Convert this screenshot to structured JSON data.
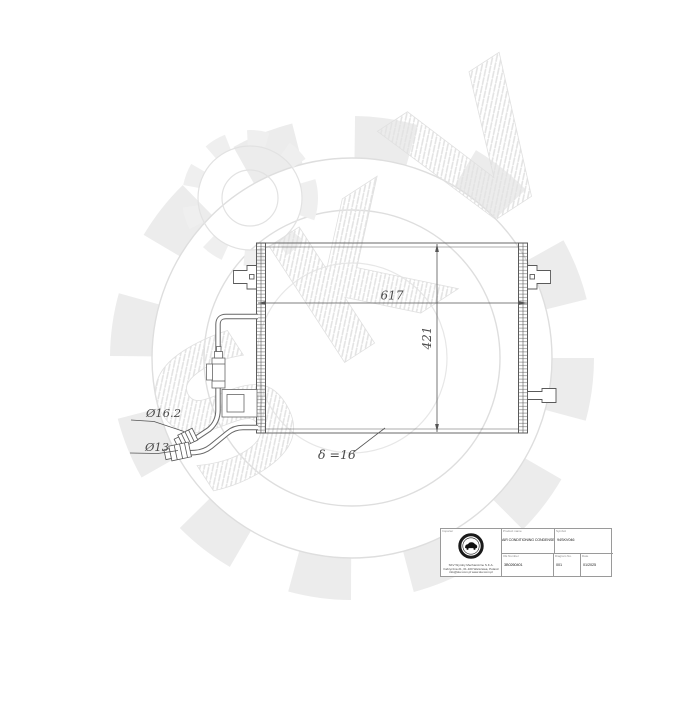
{
  "watermark": {
    "letters": [
      "S",
      "K",
      "V"
    ]
  },
  "drawing": {
    "dim_width": "617",
    "dim_height": "421",
    "dim_thickness": "δ =16",
    "dim_pipe_top": "Ø16.2",
    "dim_pipe_bottom": "Ø13"
  },
  "title_block": {
    "importer_header": "Importer",
    "importer_line1": "SKV Wyroby Mechaniczne S.K.A.",
    "importer_line2": "Fabryczna 21, 01-100 Warszawa, Poland",
    "importer_line3": "info@skv.com.pl  www.skv.com.pl",
    "product_header": "Product name",
    "product_value": "AIR CONDITIONING CONDENSER",
    "symbol_header": "Symbol",
    "symbol_value": "94SKV046",
    "oe_header": "OE Number",
    "oe_value": "3B0260401",
    "diagram_header": "Diagram No.",
    "diagram_value": "001",
    "date_header": "Date",
    "date_value": "01/2025"
  }
}
